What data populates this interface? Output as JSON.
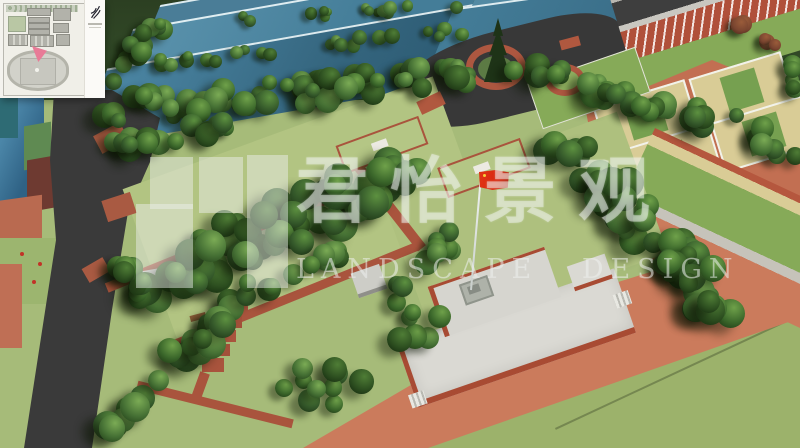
{
  "watermark": {
    "cjk_text": "君怡景观",
    "latin_text": "LANDSCAPE DESIGN"
  },
  "icons": {
    "inset_logo": "crane-logo-icon",
    "inset_marker": "location-arrow-icon"
  },
  "palette": {
    "lawn": "#a6bb79",
    "lawn-bright": "#b4c685",
    "lawn-dark": "#9cb26b",
    "tree-dark": "#223f18",
    "tree-mid": "#3a662a",
    "tree-light": "#5d9140",
    "tree-brown": "#7a4530",
    "roof-blue": "#3e7796",
    "roof-blue-light": "#5b93ad",
    "asphalt": "#3a3a3a",
    "brick-path": "#a9543d",
    "track-salmon": "#cb7b5c",
    "court-orange": "#c26f52",
    "court-tan": "#d9cc96",
    "court-green": "#76a050",
    "field-green": "#86aa58",
    "plaza-white": "#dad9d3",
    "plaza-edge": "#a84b33",
    "flag-red": "#d8290f",
    "marker-pink": "#e87b97",
    "inset-bg": "#f4f3ee",
    "inset-building": "#b2b2aa"
  }
}
